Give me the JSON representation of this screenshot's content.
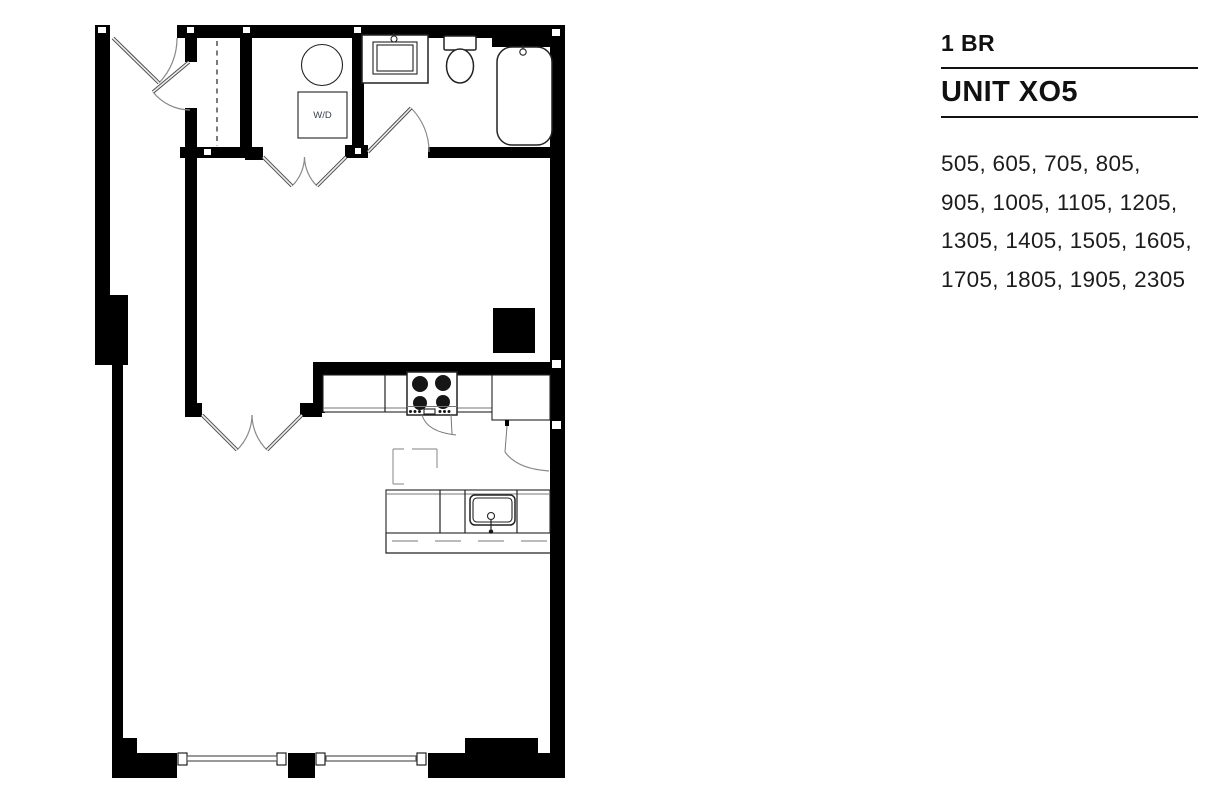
{
  "panel": {
    "bedroom_count": "1 BR",
    "unit_name": "UNIT XO5",
    "unit_numbers_lines": [
      "505, 605, 705, 805,",
      "905, 1005, 1105, 1205,",
      "1305, 1405, 1505, 1605,",
      "1705, 1805, 1905, 2305"
    ]
  },
  "floorplan": {
    "washer_dryer_label": "W/D"
  },
  "colors": {
    "wall": "#000000",
    "text": "#111111",
    "fixture_line": "#222222",
    "door_arc": "#8a8a8a",
    "background": "#ffffff"
  }
}
